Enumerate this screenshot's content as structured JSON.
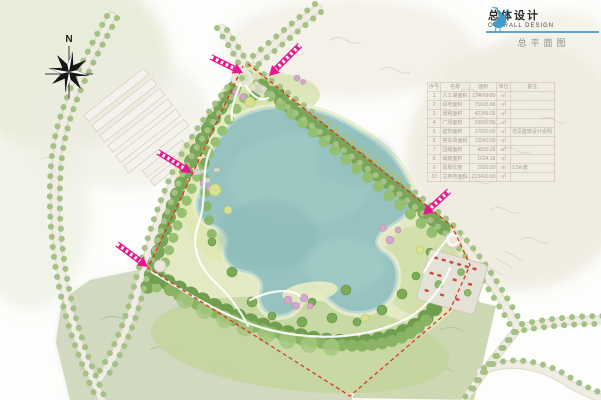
{
  "title_block": {
    "logo_icon": "crane-icon",
    "title_cn": "总体设计",
    "title_en": "OVERALL DESIGN",
    "subtitle": "总平面图",
    "accent_color": "#5aa7cc"
  },
  "compass": {
    "label": "N"
  },
  "plan": {
    "entrance_arrow_color": "#e8188c",
    "boundary_dash_color": "#e0341f",
    "lake_color": "#96c3c0",
    "entrance_arrow_count": 5
  },
  "area_table": {
    "headers": [
      "序号",
      "名称",
      "面积",
      "单位",
      "备注"
    ],
    "rows": [
      [
        "1",
        "人工湖面积",
        "134673.00",
        "㎡",
        ""
      ],
      [
        "2",
        "绿地面积",
        "75605.98",
        "㎡",
        ""
      ],
      [
        "3",
        "道路面积",
        "42348.05",
        "㎡",
        ""
      ],
      [
        "4",
        "广场面积",
        "23690.00",
        "㎡",
        ""
      ],
      [
        "5",
        "建筑面积",
        "17500.00",
        "㎡",
        "详见建筑设计说明"
      ],
      [
        "6",
        "停车场面积",
        "12540.00",
        "㎡",
        ""
      ],
      [
        "7",
        "园路面积",
        "4833.28",
        "㎡",
        ""
      ],
      [
        "8",
        "铺装面积",
        "1634.18",
        "㎡",
        ""
      ],
      [
        "9",
        "驳岸长度",
        "2030.50",
        "m",
        "2.5m宽"
      ],
      [
        "10",
        "总用地面积",
        "213400.00",
        "㎡",
        ""
      ]
    ]
  }
}
